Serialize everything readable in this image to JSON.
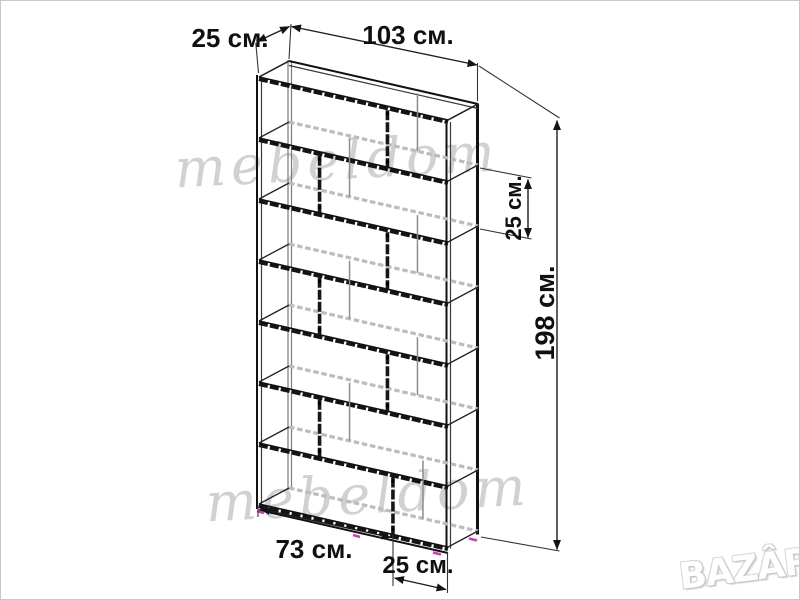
{
  "page": {
    "background": "#ffffff",
    "border_color": "#c9c9c9"
  },
  "diagram": {
    "type": "furniture-dimension-drawing",
    "object": "tall staggered shelving unit wireframe (3D line drawing)",
    "dimensions": {
      "depth_top_label": "25 см.",
      "width_top_label": "103 см.",
      "shelf_spacing_label": "25 см.",
      "height_label": "198 см.",
      "bottom_left_section_label": "73 см.",
      "bottom_right_section_label": "25 см."
    },
    "structure": {
      "width_cm": 103,
      "depth_cm": 25,
      "height_cm": 198,
      "rows": 7,
      "divider_positions_cm": [
        70,
        33,
        70,
        33,
        70,
        33,
        73
      ]
    },
    "colors": {
      "line": "#141414",
      "hidden_line": "#bcbcbc",
      "accent_marks": "#cf3cb4",
      "dimension_text": "#101010",
      "watermark": "#c9c9c9"
    }
  },
  "watermarks": {
    "script_text": "mebeldom",
    "logo_text": "BAZÂR"
  }
}
